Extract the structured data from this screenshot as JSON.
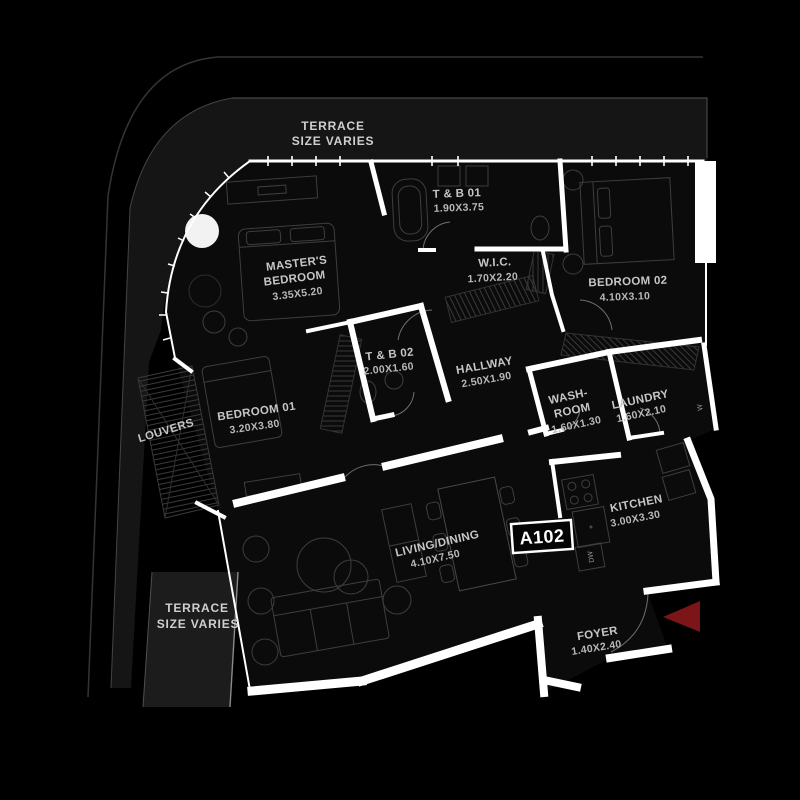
{
  "badge": {
    "label": "A102"
  },
  "terrace_top": {
    "line1": "TERRACE",
    "line2": "SIZE VARIES"
  },
  "terrace_bottom": {
    "line1": "TERRACE",
    "line2": "SIZE VARIES"
  },
  "louvers": {
    "label": "LOUVERS"
  },
  "rooms": {
    "tb01": {
      "name": "T & B 01",
      "dims": "1.90X3.75"
    },
    "master": {
      "name1": "MASTER'S",
      "name2": "BEDROOM",
      "dims": "3.35X5.20"
    },
    "wic": {
      "name": "W.I.C.",
      "dims": "1.70X2.20"
    },
    "bedroom02": {
      "name": "BEDROOM 02",
      "dims": "4.10X3.10"
    },
    "tb02": {
      "name": "T & B 02",
      "dims": "2.00X1.60"
    },
    "hallway": {
      "name": "HALLWAY",
      "dims": "2.50X1.90"
    },
    "bedroom01": {
      "name": "BEDROOM 01",
      "dims": "3.20X3.80"
    },
    "washroom": {
      "name1": "WASH-",
      "name2": "ROOM",
      "dims": "1.60X1.30"
    },
    "laundry": {
      "name": "LAUNDRY",
      "dims": "1.60X2.10"
    },
    "kitchen": {
      "name": "KITCHEN",
      "dims": "3.00X3.30"
    },
    "living": {
      "name": "LIVING/DINING",
      "dims": "4.10X7.50"
    },
    "foyer": {
      "name": "FOYER",
      "dims": "1.40X2.40"
    }
  },
  "appliances": {
    "dishwasher": "DW",
    "washer": "W"
  },
  "colors": {
    "background": "#000000",
    "floor": "#0b0b0b",
    "terrace_band": "#161616",
    "wall": "#ffffff",
    "label_text": "#c6c6c6",
    "entry_arrow": "#7c1517"
  }
}
